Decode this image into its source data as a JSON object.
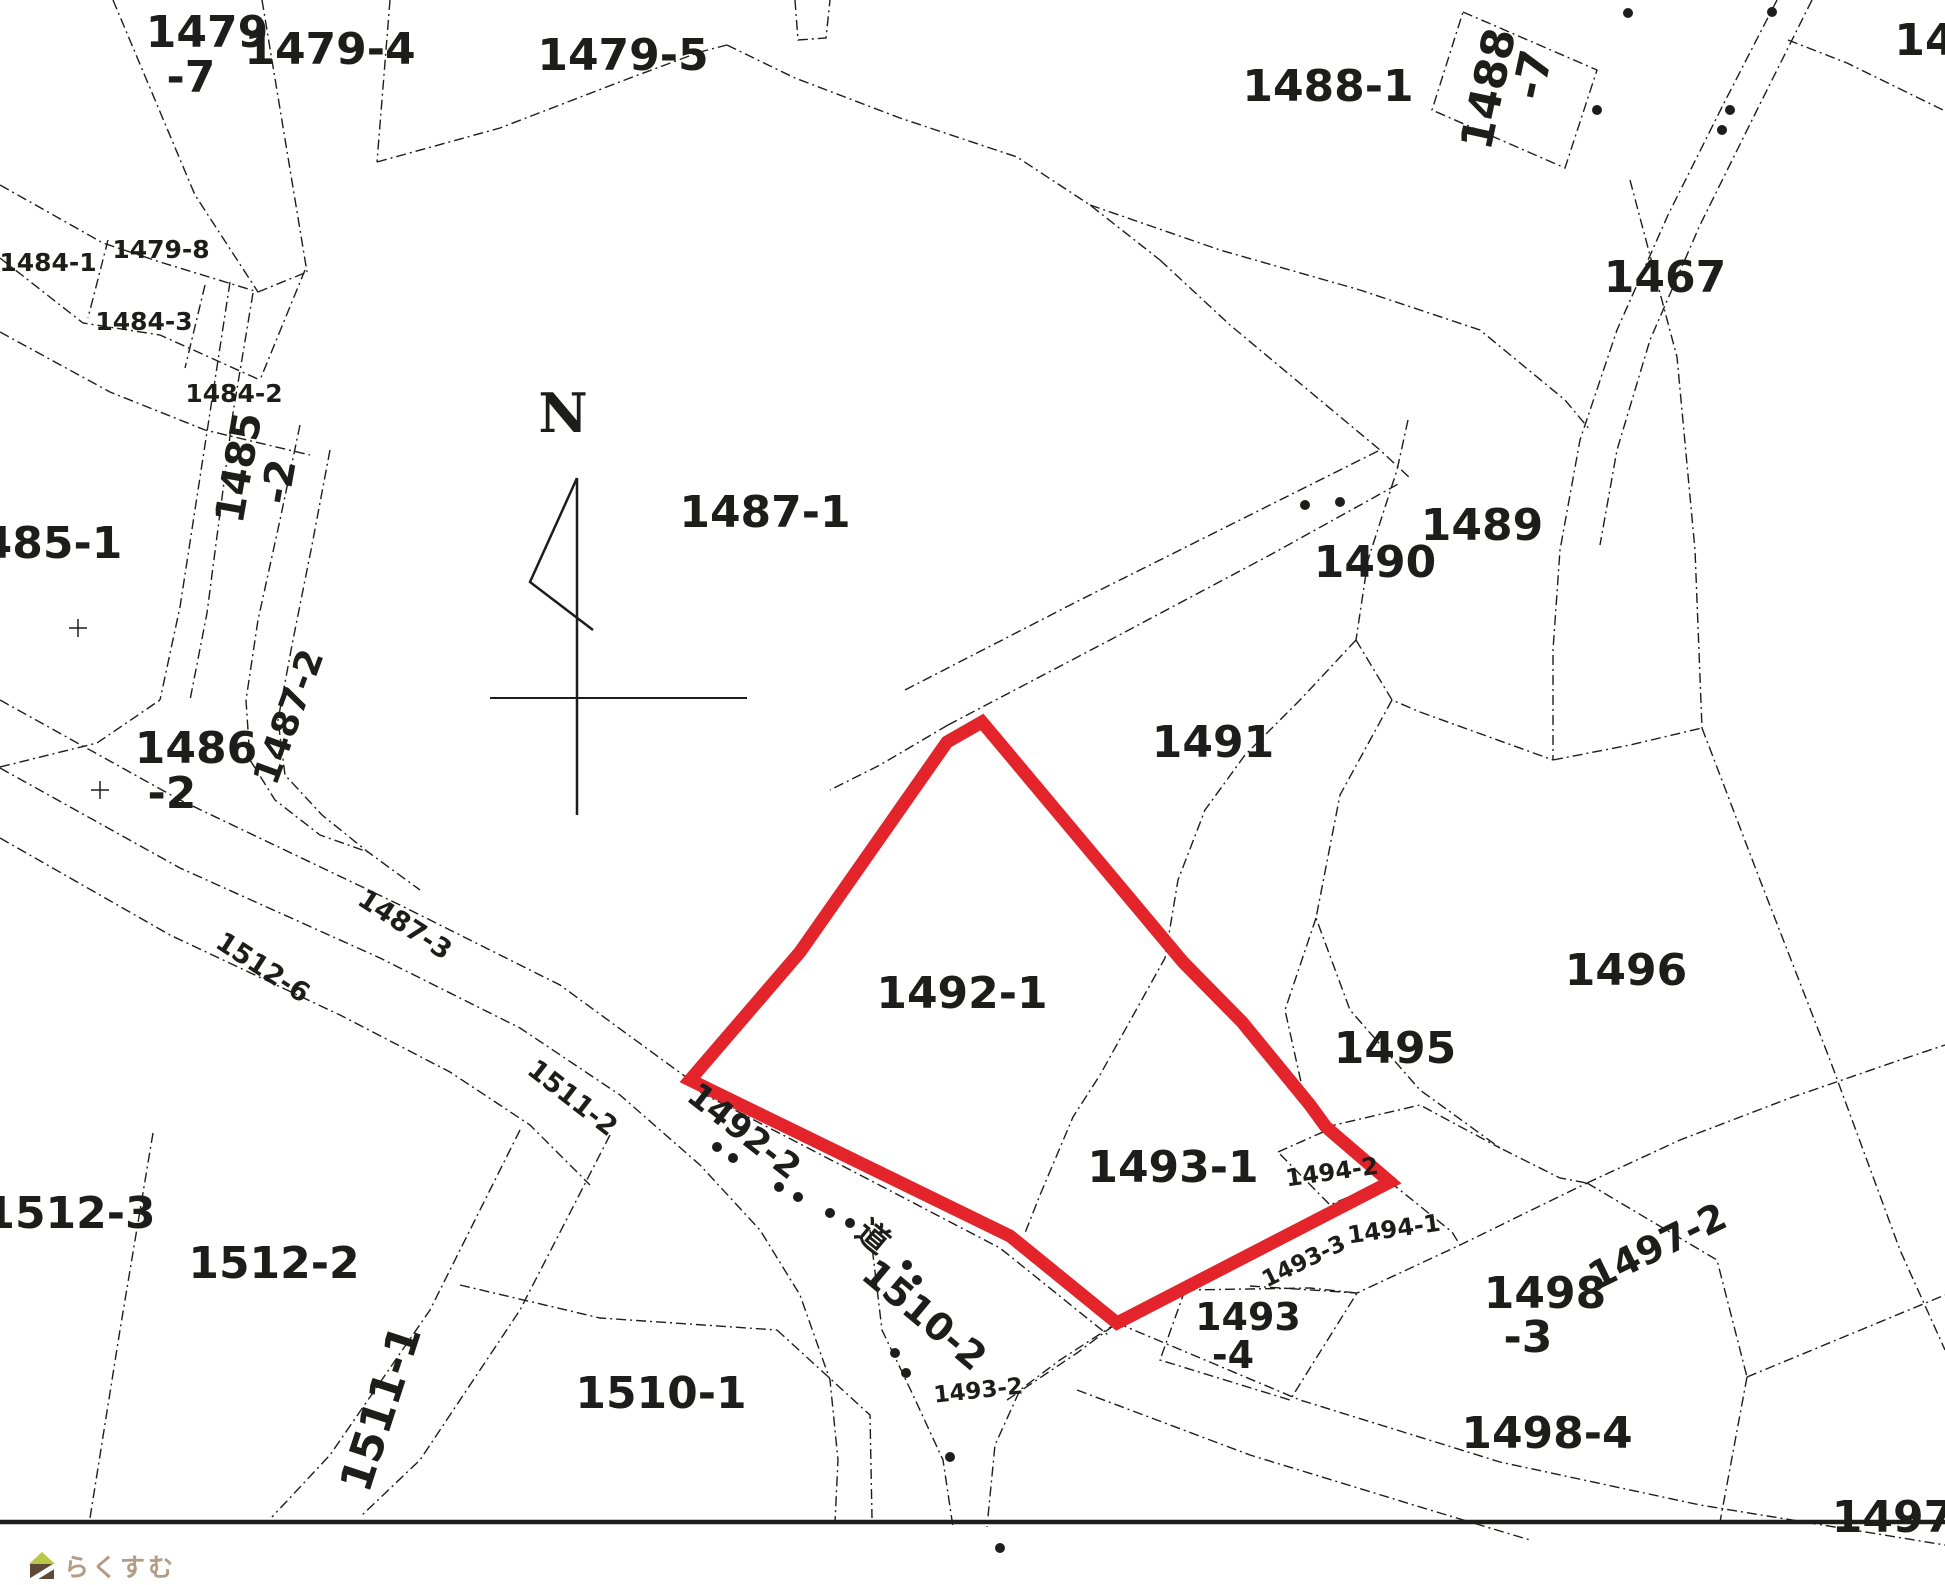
{
  "map": {
    "background": "#ffffff",
    "line_color": "#1d1d1b",
    "red_color": "#e3242b",
    "red_parcel": {
      "name": "highlighted-parcels-1492-1-1493-1",
      "points": "982,722 1183,962 1242,1022 1310,1105 1326,1127 1390,1182 1117,1323 1010,1236 690,1080 800,952 940,752 947,742",
      "stroke_width": 13
    },
    "labels": [
      {
        "id": "p1479-7a",
        "text": "1479",
        "x": 207,
        "y": 47,
        "size": 44
      },
      {
        "id": "p1479-7b",
        "text": "-7",
        "x": 191,
        "y": 92,
        "size": 44
      },
      {
        "id": "p1479-4",
        "text": "1479-4",
        "x": 330,
        "y": 64,
        "size": 44
      },
      {
        "id": "p1479-5",
        "text": "1479-5",
        "x": 623,
        "y": 70,
        "size": 44
      },
      {
        "id": "p1488-1",
        "text": "1488-1",
        "x": 1328,
        "y": 101,
        "size": 44
      },
      {
        "id": "p1488-7a",
        "text": "1488",
        "x": 1503,
        "y": 92,
        "size": 44,
        "rot": -78
      },
      {
        "id": "p1488-7b",
        "text": "-7",
        "x": 1547,
        "y": 78,
        "size": 44,
        "rot": -78
      },
      {
        "id": "p14-edge",
        "text": "14",
        "x": 1925,
        "y": 55,
        "size": 44
      },
      {
        "id": "p1467",
        "text": "1467",
        "x": 1665,
        "y": 292,
        "size": 44
      },
      {
        "id": "p1484-1",
        "text": "1484-1",
        "x": 48,
        "y": 271,
        "size": 25
      },
      {
        "id": "p1479-8",
        "text": "1479-8",
        "x": 161,
        "y": 258,
        "size": 25
      },
      {
        "id": "p1484-3",
        "text": "1484-3",
        "x": 144,
        "y": 330,
        "size": 25
      },
      {
        "id": "p1484-2",
        "text": "1484-2",
        "x": 234,
        "y": 402,
        "size": 25
      },
      {
        "id": "p1485-2a",
        "text": "1485",
        "x": 252,
        "y": 470,
        "size": 40,
        "rot": -80
      },
      {
        "id": "p1485-2b",
        "text": "-2",
        "x": 292,
        "y": 484,
        "size": 40,
        "rot": -80
      },
      {
        "id": "p1485-1",
        "text": "485-1",
        "x": 52,
        "y": 558,
        "size": 44
      },
      {
        "id": "p1486-2a",
        "text": "1486",
        "x": 196,
        "y": 763,
        "size": 44
      },
      {
        "id": "p1486-2b",
        "text": "-2",
        "x": 172,
        "y": 808,
        "size": 44
      },
      {
        "id": "p1487-2",
        "text": "1487-2",
        "x": 300,
        "y": 721,
        "size": 36,
        "rot": -70
      },
      {
        "id": "p1487-1",
        "text": "1487-1",
        "x": 765,
        "y": 527,
        "size": 44
      },
      {
        "id": "p1490",
        "text": "1490",
        "x": 1375,
        "y": 577,
        "size": 44
      },
      {
        "id": "p1489",
        "text": "1489",
        "x": 1482,
        "y": 540,
        "size": 44
      },
      {
        "id": "p1491",
        "text": "1491",
        "x": 1213,
        "y": 757,
        "size": 44
      },
      {
        "id": "p1496",
        "text": "1496",
        "x": 1626,
        "y": 985,
        "size": 44
      },
      {
        "id": "p1495",
        "text": "1495",
        "x": 1395,
        "y": 1063,
        "size": 44
      },
      {
        "id": "p1492-1",
        "text": "1492-1",
        "x": 962,
        "y": 1008,
        "size": 44
      },
      {
        "id": "p1493-1",
        "text": "1493-1",
        "x": 1173,
        "y": 1182,
        "size": 44
      },
      {
        "id": "p1494-2",
        "text": "1494-2",
        "x": 1333,
        "y": 1180,
        "size": 24,
        "rot": -8
      },
      {
        "id": "p1494-1",
        "text": "1494-1",
        "x": 1395,
        "y": 1237,
        "size": 24,
        "rot": -8
      },
      {
        "id": "p1493-3",
        "text": "1493-3",
        "x": 1307,
        "y": 1268,
        "size": 23,
        "rot": -26
      },
      {
        "id": "p1493-4a",
        "text": "1493",
        "x": 1248,
        "y": 1330,
        "size": 38
      },
      {
        "id": "p1493-4b",
        "text": "-4",
        "x": 1233,
        "y": 1368,
        "size": 38
      },
      {
        "id": "p1498-3a",
        "text": "1498",
        "x": 1545,
        "y": 1308,
        "size": 44
      },
      {
        "id": "p1498-3b",
        "text": "-3",
        "x": 1528,
        "y": 1352,
        "size": 44
      },
      {
        "id": "p1497-2",
        "text": "1497-2",
        "x": 1663,
        "y": 1258,
        "size": 38,
        "rot": -26
      },
      {
        "id": "p1498-4",
        "text": "1498-4",
        "x": 1547,
        "y": 1448,
        "size": 44
      },
      {
        "id": "p1493-2",
        "text": "1493-2",
        "x": 979,
        "y": 1398,
        "size": 23,
        "rot": -6
      },
      {
        "id": "p1510-1",
        "text": "1510-1",
        "x": 661,
        "y": 1408,
        "size": 44
      },
      {
        "id": "p1510-2",
        "text": "1510-2",
        "x": 916,
        "y": 1325,
        "size": 38,
        "rot": 40
      },
      {
        "id": "p1511-1",
        "text": "1511-1",
        "x": 395,
        "y": 1413,
        "size": 44,
        "rot": -72
      },
      {
        "id": "p1512-2",
        "text": "1512-2",
        "x": 274,
        "y": 1278,
        "size": 44
      },
      {
        "id": "p1512-3",
        "text": "1512-3",
        "x": 70,
        "y": 1228,
        "size": 44
      },
      {
        "id": "p1511-2",
        "text": "1511-2",
        "x": 567,
        "y": 1105,
        "size": 27,
        "rot": 38
      },
      {
        "id": "p1487-3",
        "text": "1487-3",
        "x": 400,
        "y": 932,
        "size": 27,
        "rot": 33
      },
      {
        "id": "p1512-6",
        "text": "1512-6",
        "x": 258,
        "y": 975,
        "size": 27,
        "rot": 33
      },
      {
        "id": "road-kanji",
        "text": "道",
        "x": 866,
        "y": 1245,
        "size": 32,
        "rot": 40
      },
      {
        "id": "p1492-2",
        "text": "1492-2",
        "x": 737,
        "y": 1140,
        "size": 34,
        "rot": 38
      },
      {
        "id": "p1497",
        "text": "1497",
        "x": 1893,
        "y": 1532,
        "size": 44
      },
      {
        "id": "north-letter",
        "text": "N",
        "x": 563,
        "y": 432,
        "size": 54,
        "serif": true
      }
    ],
    "boundaries": [
      {
        "points": "113,0 195,195 258,292"
      },
      {
        "points": "262,0 307,272"
      },
      {
        "points": "258,292 307,272"
      },
      {
        "points": "390,0 377,162"
      },
      {
        "points": "377,162 500,128 630,78 700,52 727,45"
      },
      {
        "points": "727,45 795,78 900,118 1017,157 1090,205 1160,260"
      },
      {
        "points": "1160,260 1230,325 1320,400 1380,450 1410,478"
      },
      {
        "points": "1090,205 1220,250 1360,290 1480,330 1565,400 1590,430"
      },
      {
        "points": "905,690 1080,600 1250,515 1380,450"
      },
      {
        "points": "948,725 1110,640 1270,555 1400,483"
      },
      {
        "points": "948,725 880,765 830,790"
      },
      {
        "points": "1408,420 1397,470 1368,560 1356,640"
      },
      {
        "points": "1356,640 1392,700 1420,712"
      },
      {
        "points": "1420,712 1553,760"
      },
      {
        "points": "1553,760 1630,745 1702,728"
      },
      {
        "points": "1702,728 1760,880 1830,1060 1900,1250 1945,1350"
      },
      {
        "points": "1630,180 1677,357 1695,550 1702,728"
      },
      {
        "points": "1356,640 1300,700 1245,755 1205,810 1178,880 1165,958 1100,1075 1073,1117 1040,1195 1025,1233"
      },
      {
        "points": "1316,918 1285,1010 1305,1100"
      },
      {
        "points": "1392,700 1340,795 1316,918 1350,1010 1420,1090 1500,1148 1560,1178 1587,1183"
      },
      {
        "points": "1777,0 1723,105 1668,215 1617,330 1580,440 1560,550 1553,650 1553,760"
      },
      {
        "points": "1812,0 1757,110 1700,225 1650,340 1617,450 1600,545"
      },
      {
        "points": "1788,40 1847,63 1943,110"
      },
      {
        "points": "1463,12 1597,70 1565,168 1432,110 1463,12"
      },
      {
        "points": "0,185 103,243 160,262 258,292"
      },
      {
        "points": "0,258 83,323 160,335 260,380"
      },
      {
        "points": "0,332 110,392 205,430 310,455"
      },
      {
        "points": "108,240 88,318"
      },
      {
        "points": "205,285 185,368"
      },
      {
        "points": "305,270 260,380"
      },
      {
        "points": "230,282 213,393 180,607 160,700"
      },
      {
        "points": "253,293 233,413 207,613 190,700"
      },
      {
        "points": "300,425 280,520 258,620 246,700 250,760 275,800 320,835 368,852"
      },
      {
        "points": "330,450 312,545 292,645 278,720 285,775 322,815 368,852 420,890"
      },
      {
        "points": "0,767 97,743 160,700"
      },
      {
        "points": "0,700 180,800 400,905 560,985 690,1080"
      },
      {
        "points": "0,768 180,868 380,958 520,1028 620,1095 700,1165 760,1230 800,1295 830,1380 838,1460 835,1522"
      },
      {
        "points": "0,838 170,935 340,1015 450,1072 530,1125 590,1185"
      },
      {
        "points": "700,1092 860,1175 1000,1248 1108,1335"
      },
      {
        "points": "870,1230 882,1330 913,1395 943,1460 953,1527"
      },
      {
        "points": "1117,1323 1060,1360 1020,1390 995,1445 987,1527"
      },
      {
        "points": "1007,1400 1077,1353 1117,1323"
      },
      {
        "points": "1117,1323 1300,1400 1500,1462 1700,1505 1945,1545"
      },
      {
        "points": "1077,1390 1250,1455 1430,1510 1530,1540"
      },
      {
        "points": "1185,1290 1310,1288 1357,1293"
      },
      {
        "points": "1185,1290 1160,1360 1290,1400 1357,1293"
      },
      {
        "points": "1250,1286 1357,1293 1460,1245 1587,1183"
      },
      {
        "points": "1587,1183 1717,1260 1747,1377"
      },
      {
        "points": "1747,1377 1945,1295"
      },
      {
        "points": "1747,1377 1720,1522"
      },
      {
        "points": "1587,1183 1680,1140 1790,1098 1900,1060 1945,1045"
      },
      {
        "points": "1326,1127 1420,1105 1500,1148"
      },
      {
        "points": "1390,1182 1452,1232 1460,1245"
      },
      {
        "points": "1278,1152 1332,1128 1388,1180 1330,1205 1278,1152"
      },
      {
        "points": "153,1133 120,1330 90,1518"
      },
      {
        "points": "520,1130 430,1310 330,1455 272,1517"
      },
      {
        "points": "610,1135 520,1310 420,1460 360,1517"
      },
      {
        "points": "460,1285 600,1318 777,1330"
      },
      {
        "points": "777,1330 870,1415 872,1518"
      },
      {
        "points": "795,0 798,40 826,38 830,0"
      },
      {
        "points": "0,1522 1945,1522",
        "dash": false,
        "width": 4.5
      }
    ],
    "compass": {
      "lines": [
        {
          "points": "577,478 577,815",
          "width": 2.5
        },
        {
          "points": "577,478 530,582 593,630",
          "width": 2.5
        },
        {
          "points": "490,698 747,698",
          "width": 2
        }
      ]
    },
    "dots": [
      [
        1305,
        505
      ],
      [
        1340,
        502
      ],
      [
        1772,
        12
      ],
      [
        1730,
        110
      ],
      [
        1722,
        130
      ],
      [
        1628,
        13
      ],
      [
        1597,
        110
      ],
      [
        717,
        1147
      ],
      [
        733,
        1158
      ],
      [
        779,
        1187
      ],
      [
        798,
        1197
      ],
      [
        830,
        1213
      ],
      [
        850,
        1223
      ],
      [
        907,
        1265
      ],
      [
        917,
        1280
      ],
      [
        895,
        1353
      ],
      [
        906,
        1373
      ],
      [
        950,
        1457
      ],
      [
        1000,
        1548
      ]
    ],
    "crosses": [
      [
        100,
        790
      ],
      [
        78,
        628
      ]
    ],
    "watermark": {
      "text": "らくすむ",
      "text_color": "#b39b84",
      "roof_color": "#b9c746",
      "body_color": "#5f4a38"
    }
  }
}
